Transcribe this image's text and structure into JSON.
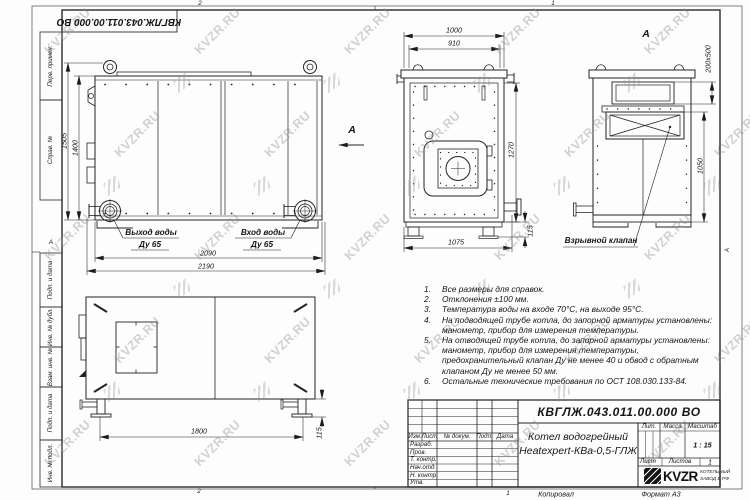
{
  "doc": {
    "number": "КВГЛЖ.043.011.00.000 ВО",
    "product_line1": "Котел водогрейный",
    "product_line2": "Heatexpert-КВа-0,5-ГЛЖ",
    "copied": "Копировал",
    "format": "Формат А3",
    "scale": "1 : 15",
    "sheets_value": "1"
  },
  "title_block": {
    "headers": {
      "izm": "Изм.",
      "list": "Лист",
      "doc": "№ докум.",
      "podp": "Подп.",
      "data": "Дата"
    },
    "roles": [
      "Разраб.",
      "Пров.",
      "Т. контр.",
      "Нач.отд.",
      "Н. контр.",
      "Утв."
    ],
    "lit": "Лит.",
    "mass": "Масса",
    "scale_label": "Масштаб",
    "sheet_label": "Лист",
    "sheets_label": "Листов",
    "brand": "KVZR",
    "brand_line1": "КОТЕЛЬНЫЙ",
    "brand_line2": "ЗАВОД В РФ"
  },
  "stamps": [
    "Перв. примен.",
    "Справ. №",
    "Подп. и дата",
    "Инв. № дубл.",
    "Взам. инв. №",
    "Подп. и дата",
    "Инв. № подл."
  ],
  "zones": {
    "top_left": "2",
    "top_right": "1",
    "bottom_left": "2",
    "bottom_right": "1",
    "left": "А",
    "right": "А"
  },
  "views": {
    "arrow_label": "А",
    "rear_title": "А",
    "outlet_line1": "Выход воды",
    "outlet_line2": "Ду 65",
    "inlet_line1": "Вход воды",
    "inlet_line2": "Ду 65",
    "explosion_valve": "Взрывной клапан"
  },
  "dims": {
    "side_total_h": "1505",
    "side_body_h": "1400",
    "side_body_w": "2090",
    "side_total_w": "2190",
    "front_w": "1000",
    "front_inner_w": "910",
    "front_h": "1270",
    "front_base_w": "1075",
    "front_foot_h": "115",
    "rear_valve": "200х500",
    "rear_h": "1050",
    "bottom_span": "1800",
    "bottom_foot_h": "115"
  },
  "notes": {
    "items": [
      {
        "n": "1.",
        "t": "Все размеры для справок."
      },
      {
        "n": "2.",
        "t": "Отклонения ±100 мм."
      },
      {
        "n": "3.",
        "t": "Температура воды на входе 70°С, на выходе 95°С."
      },
      {
        "n": "4.",
        "t": "На подводящей трубе котла, до запорной арматуры установлены: манометр, прибор для измерения температуры."
      },
      {
        "n": "5.",
        "t": "На отводящей трубе котла, до запорной арматуры установлены: манометр, прибор для измерения температуры, предохранительный клапан Ду не менее 40 и обвод с обратным клапаном Ду не менее 50 мм."
      },
      {
        "n": "6.",
        "t": "Остальные технические требования по ОСТ 108.030.133-84."
      }
    ]
  },
  "watermark": {
    "text": "KVZR.RU"
  }
}
